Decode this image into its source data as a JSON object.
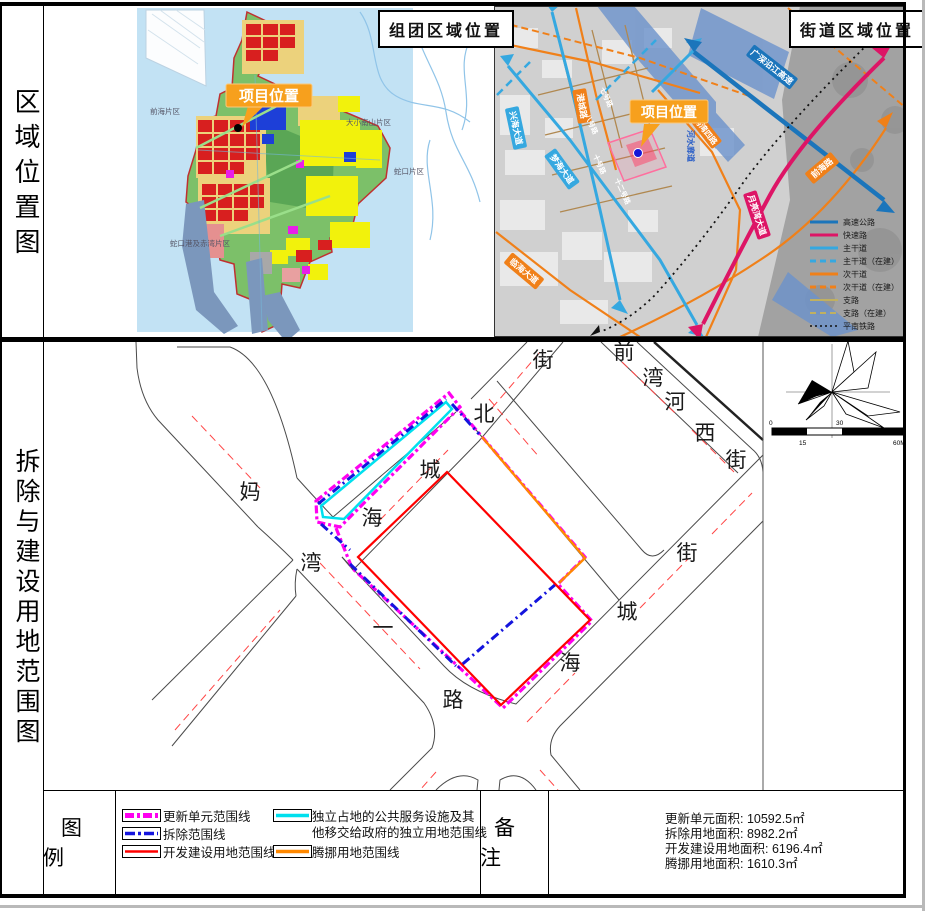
{
  "colors": {
    "unit_magenta": "#ff00f0",
    "demolition_blue": "#1414dd",
    "development_red": "#ff0000",
    "public_cyan": "#00e0ee",
    "relocation_orange": "#ff8800",
    "callout_orange": "#f7a01d",
    "highway_blue": "#1b75bb",
    "express_pink": "#dd1566",
    "arterial_cyan": "#35a8e0",
    "secondary_orange": "#f08019",
    "branch_tan": "#c0b060"
  },
  "side": {
    "top": "区域位置图",
    "middle": "拆除与建设用地范围图"
  },
  "cluster_map": {
    "title": "组团区域位置",
    "callout": "项目位置",
    "labels": [
      "前海片区",
      "大小南山片区",
      "蛇口片区",
      "蛇口港及赤湾片区"
    ]
  },
  "street_map": {
    "title": "街道区域位置",
    "callout": "项目位置",
    "roads": [
      "兴海大道",
      "梦海大道",
      "临海大道",
      "港城路",
      "广深沿江高速",
      "月亮湾大道",
      "前海路",
      "妈湾四路",
      "河水廊道",
      "七号路",
      "八号路",
      "十号路",
      "十二号路"
    ],
    "legend": [
      {
        "label": "高速公路"
      },
      {
        "label": "快速路"
      },
      {
        "label": "主干道"
      },
      {
        "label": "主干道（在建）"
      },
      {
        "label": "次干道"
      },
      {
        "label": "次干道（在建）"
      },
      {
        "label": "支路"
      },
      {
        "label": "支路（在建）"
      },
      {
        "label": "平南铁路"
      }
    ]
  },
  "demo_map": {
    "streets": [
      {
        "name": "妈湾一路"
      },
      {
        "name": "海城北街"
      },
      {
        "name": "前湾河西街"
      },
      {
        "name": "海城街"
      }
    ],
    "north": "N",
    "scale": [
      "0",
      "15",
      "30",
      "60M"
    ]
  },
  "legend_row": {
    "heading": "图例",
    "items": [
      {
        "label": "更新单元范围线"
      },
      {
        "label": "拆除范围线"
      },
      {
        "label": "开发建设用地范围线"
      },
      {
        "label": "独立占地的公共服务设施及其",
        "label2": "他移交给政府的独立用地范围线"
      },
      {
        "label": "腾挪用地范围线"
      }
    ]
  },
  "remarks": {
    "heading": "备注",
    "lines": [
      "更新单元面积: 10592.5㎡",
      "拆除用地面积: 8982.2㎡",
      "开发建设用地面积: 6196.4㎡",
      "腾挪用地面积: 1610.3㎡"
    ]
  }
}
